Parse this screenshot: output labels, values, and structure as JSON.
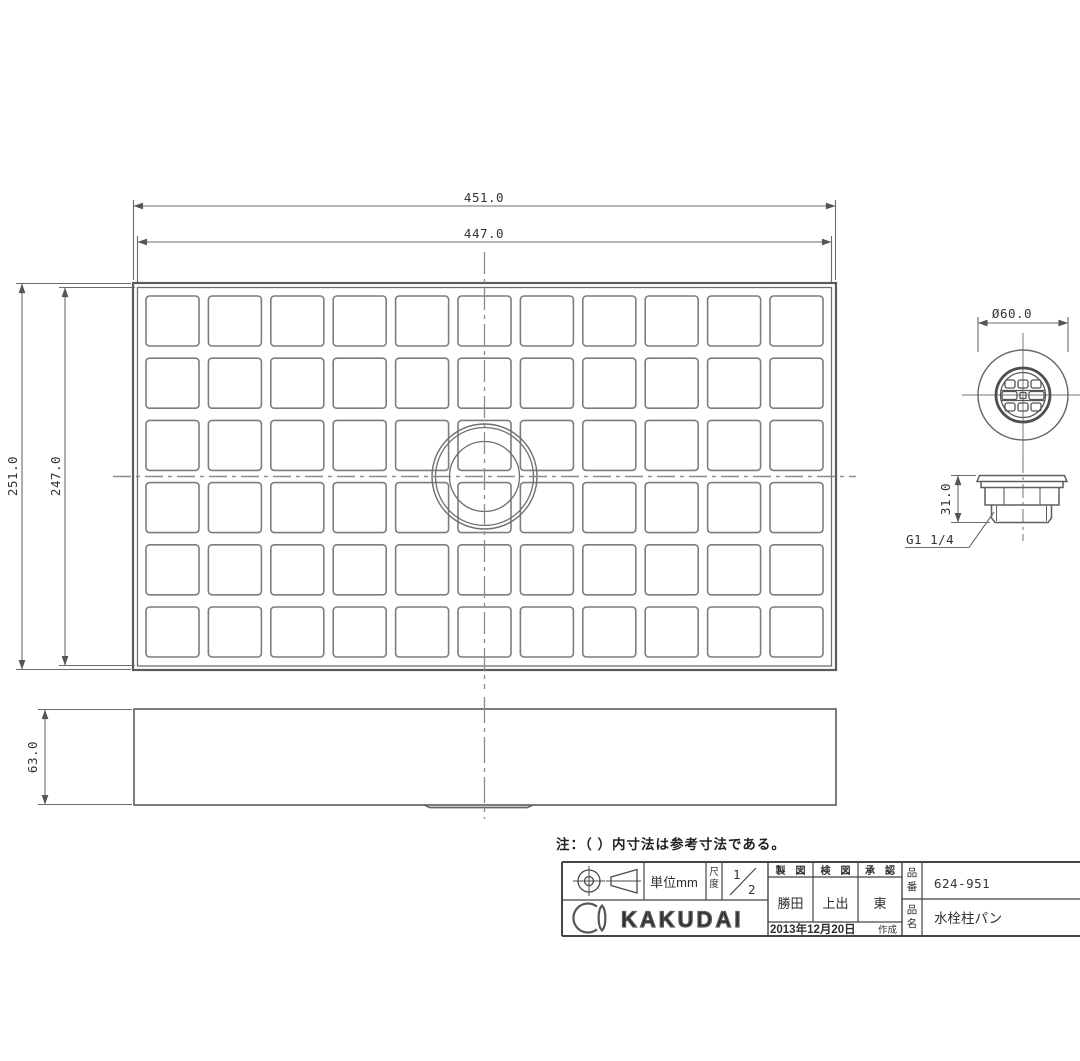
{
  "colors": {
    "background": "#ffffff",
    "line": "#6b6b6b",
    "line_dark": "#474747",
    "text": "#2e2e2e"
  },
  "note": "注：（ ）内寸法は参考寸法である。",
  "plan_view": {
    "width_outer": "451.0",
    "width_inner": "447.0",
    "height_outer": "251.0",
    "height_inner": "247.0",
    "grid": {
      "cols": 11,
      "rows": 6
    }
  },
  "front_view": {
    "height": "63.0"
  },
  "drain_top_view": {
    "diameter": "Ø60.0"
  },
  "drain_side_view": {
    "height": "31.0",
    "thread_label": "G1 1/4"
  },
  "title_block": {
    "unit": "単位mm",
    "scale_label_chars": [
      "尺",
      "度"
    ],
    "scale": {
      "numerator": "1",
      "denominator": "2"
    },
    "headers": {
      "drafted": "製　図",
      "checked": "検　図",
      "approved": "承　認"
    },
    "names": {
      "drafted": "勝田",
      "checked": "上出",
      "approved": "東"
    },
    "date": "2013年12月20日",
    "date_suffix": "作成",
    "part_no_label": [
      "品",
      "番"
    ],
    "part_no": "624-951",
    "part_name_label": [
      "品",
      "名"
    ],
    "part_name": "水栓柱パン",
    "brand": "KAKUDAI"
  }
}
